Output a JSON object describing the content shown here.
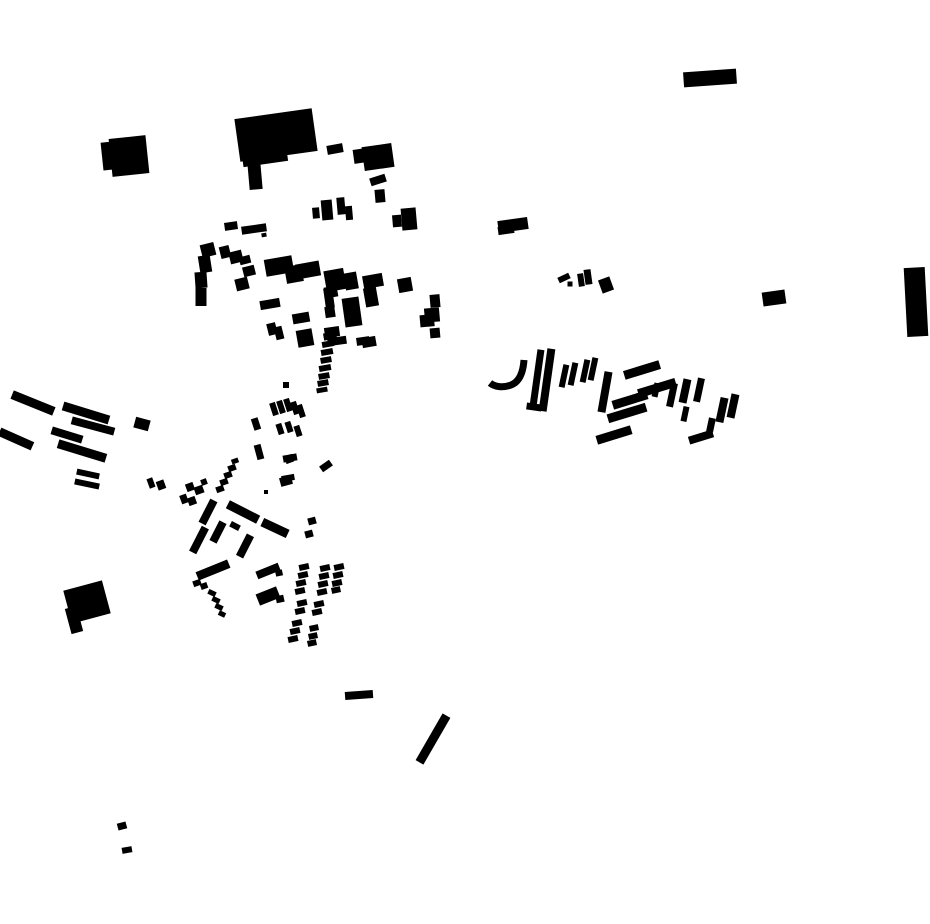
{
  "map": {
    "title": "building-footprint-figure-ground-map",
    "canvas": {
      "width": 930,
      "height": 924,
      "background": "#ffffff",
      "ink": "#000000"
    },
    "buildings": [
      [
        710,
        78,
        53,
        15,
        -4
      ],
      [
        108,
        156,
        12,
        28,
        -6
      ],
      [
        129,
        156,
        37,
        38,
        -6
      ],
      [
        276,
        135,
        78,
        43,
        -8
      ],
      [
        265,
        158,
        45,
        12,
        -8
      ],
      [
        255,
        176,
        13,
        27,
        -5
      ],
      [
        335,
        149,
        16,
        9,
        -10
      ],
      [
        360,
        156,
        13,
        14,
        -8
      ],
      [
        378,
        157,
        30,
        24,
        -8
      ],
      [
        378,
        180,
        16,
        8,
        -18
      ],
      [
        380,
        196,
        10,
        13,
        -5
      ],
      [
        316,
        213,
        7,
        11,
        -5
      ],
      [
        327,
        210,
        11,
        20,
        -5
      ],
      [
        341,
        206,
        8,
        17,
        -5
      ],
      [
        349,
        213,
        7,
        14,
        -5
      ],
      [
        397,
        221,
        9,
        12,
        -5
      ],
      [
        409,
        219,
        15,
        22,
        -5
      ],
      [
        231,
        226,
        13,
        8,
        -8
      ],
      [
        254,
        229,
        25,
        8,
        -8
      ],
      [
        264,
        235,
        5,
        4,
        -10
      ],
      [
        208,
        250,
        14,
        13,
        -14
      ],
      [
        205,
        264,
        12,
        17,
        -9
      ],
      [
        201,
        280,
        12,
        16,
        -4
      ],
      [
        201,
        297,
        11,
        18,
        0
      ],
      [
        225,
        252,
        10,
        12,
        -14
      ],
      [
        236,
        257,
        13,
        12,
        -14
      ],
      [
        245,
        260,
        11,
        8,
        -14
      ],
      [
        249,
        271,
        12,
        10,
        -14
      ],
      [
        242,
        284,
        13,
        12,
        -14
      ],
      [
        279,
        266,
        28,
        17,
        -10
      ],
      [
        294,
        274,
        17,
        17,
        -10
      ],
      [
        308,
        270,
        24,
        15,
        -10
      ],
      [
        329,
        298,
        9,
        20,
        -8
      ],
      [
        270,
        304,
        20,
        9,
        -10
      ],
      [
        335,
        280,
        20,
        21,
        -10
      ],
      [
        331,
        292,
        13,
        11,
        -10
      ],
      [
        351,
        281,
        13,
        17,
        -10
      ],
      [
        373,
        281,
        20,
        13,
        -10
      ],
      [
        371,
        297,
        13,
        19,
        -10
      ],
      [
        405,
        285,
        14,
        14,
        -10
      ],
      [
        352,
        312,
        17,
        29,
        -8
      ],
      [
        330,
        312,
        10,
        11,
        -8
      ],
      [
        332,
        332,
        15,
        10,
        -8
      ],
      [
        337,
        341,
        19,
        8,
        -8
      ],
      [
        363,
        341,
        13,
        8,
        -8
      ],
      [
        369,
        342,
        14,
        10,
        -10
      ],
      [
        435,
        301,
        10,
        13,
        -5
      ],
      [
        432,
        315,
        15,
        14,
        -5
      ],
      [
        431,
        324,
        7,
        5,
        -5
      ],
      [
        435,
        333,
        10,
        10,
        -5
      ],
      [
        424,
        321,
        8,
        12,
        -5
      ],
      [
        301,
        318,
        17,
        10,
        -10
      ],
      [
        272,
        329,
        9,
        12,
        -14
      ],
      [
        279,
        333,
        8,
        13,
        -14
      ],
      [
        305,
        338,
        16,
        17,
        -10
      ],
      [
        330,
        336,
        13,
        7,
        -10
      ],
      [
        328,
        344,
        12,
        6,
        -10
      ],
      [
        327,
        352,
        12,
        6,
        -10
      ],
      [
        326,
        360,
        11,
        6,
        -10
      ],
      [
        325,
        368,
        12,
        6,
        -10
      ],
      [
        324,
        376,
        11,
        6,
        -10
      ],
      [
        323,
        383,
        11,
        6,
        -10
      ],
      [
        322,
        390,
        11,
        5,
        -10
      ],
      [
        286,
        385,
        6,
        6,
        0
      ],
      [
        274,
        409,
        6,
        13,
        -18
      ],
      [
        281,
        407,
        6,
        13,
        -18
      ],
      [
        288,
        405,
        6,
        13,
        -18
      ],
      [
        295,
        408,
        6,
        13,
        -18
      ],
      [
        301,
        411,
        6,
        13,
        -18
      ],
      [
        256,
        424,
        7,
        12,
        -18
      ],
      [
        280,
        429,
        6,
        11,
        -18
      ],
      [
        289,
        427,
        6,
        11,
        -18
      ],
      [
        298,
        431,
        6,
        11,
        -18
      ],
      [
        259,
        452,
        7,
        15,
        -15
      ],
      [
        290,
        458,
        14,
        7,
        -10
      ],
      [
        326,
        466,
        12,
        7,
        -35
      ],
      [
        288,
        478,
        13,
        6,
        -10
      ],
      [
        289,
        459,
        8,
        8,
        -20
      ],
      [
        33,
        403,
        45,
        9,
        22
      ],
      [
        86,
        413,
        48,
        9,
        17
      ],
      [
        16,
        439,
        36,
        9,
        24
      ],
      [
        93,
        426,
        44,
        8,
        15
      ],
      [
        67,
        435,
        32,
        8,
        17
      ],
      [
        82,
        451,
        50,
        9,
        17
      ],
      [
        142,
        424,
        15,
        11,
        15
      ],
      [
        88,
        474,
        23,
        6,
        12
      ],
      [
        87,
        484,
        25,
        6,
        12
      ],
      [
        151,
        483,
        6,
        10,
        -20
      ],
      [
        161,
        485,
        8,
        9,
        -20
      ],
      [
        190,
        487,
        8,
        8,
        -20
      ],
      [
        199,
        490,
        9,
        8,
        -20
      ],
      [
        204,
        482,
        6,
        6,
        -20
      ],
      [
        184,
        499,
        7,
        9,
        -20
      ],
      [
        192,
        501,
        8,
        8,
        -20
      ],
      [
        220,
        489,
        8,
        6,
        -20
      ],
      [
        224,
        482,
        8,
        6,
        -20
      ],
      [
        228,
        475,
        8,
        6,
        -20
      ],
      [
        232,
        468,
        8,
        6,
        -20
      ],
      [
        235,
        461,
        7,
        5,
        -20
      ],
      [
        286,
        481,
        12,
        9,
        -15
      ],
      [
        266,
        492,
        4,
        4,
        0
      ],
      [
        312,
        521,
        8,
        7,
        -15
      ],
      [
        309,
        534,
        8,
        7,
        -15
      ],
      [
        208,
        512,
        8,
        26,
        27
      ],
      [
        243,
        512,
        34,
        9,
        27
      ],
      [
        275,
        528,
        28,
        9,
        25
      ],
      [
        199,
        540,
        8,
        28,
        27
      ],
      [
        218,
        532,
        8,
        22,
        27
      ],
      [
        235,
        526,
        10,
        6,
        27
      ],
      [
        245,
        546,
        8,
        24,
        27
      ],
      [
        213,
        570,
        34,
        9,
        -22
      ],
      [
        268,
        571,
        24,
        8,
        -22
      ],
      [
        197,
        583,
        8,
        6,
        -20
      ],
      [
        204,
        586,
        7,
        6,
        -20
      ],
      [
        268,
        596,
        22,
        12,
        -22
      ],
      [
        212,
        593,
        8,
        5,
        25
      ],
      [
        216,
        600,
        8,
        5,
        25
      ],
      [
        219,
        607,
        8,
        5,
        25
      ],
      [
        222,
        614,
        7,
        5,
        25
      ],
      [
        304,
        567,
        10,
        6,
        -12
      ],
      [
        303,
        575,
        10,
        6,
        -12
      ],
      [
        301,
        583,
        10,
        6,
        -12
      ],
      [
        300,
        591,
        10,
        6,
        -12
      ],
      [
        302,
        603,
        10,
        6,
        -12
      ],
      [
        300,
        611,
        10,
        6,
        -12
      ],
      [
        297,
        623,
        10,
        6,
        -12
      ],
      [
        295,
        631,
        10,
        6,
        -12
      ],
      [
        293,
        639,
        10,
        6,
        -12
      ],
      [
        325,
        568,
        10,
        6,
        -12
      ],
      [
        324,
        576,
        10,
        6,
        -12
      ],
      [
        323,
        584,
        10,
        6,
        -12
      ],
      [
        322,
        592,
        10,
        6,
        -12
      ],
      [
        319,
        604,
        10,
        6,
        -12
      ],
      [
        317,
        612,
        10,
        6,
        -12
      ],
      [
        314,
        628,
        9,
        6,
        -12
      ],
      [
        313,
        636,
        9,
        6,
        -12
      ],
      [
        312,
        643,
        9,
        6,
        -12
      ],
      [
        339,
        567,
        10,
        6,
        -12
      ],
      [
        338,
        575,
        10,
        6,
        -12
      ],
      [
        337,
        583,
        10,
        6,
        -12
      ],
      [
        336,
        590,
        9,
        6,
        -12
      ],
      [
        279,
        573,
        7,
        6,
        -12
      ],
      [
        280,
        599,
        8,
        7,
        -12
      ],
      [
        87,
        602,
        40,
        34,
        -15
      ],
      [
        74,
        620,
        12,
        26,
        -15
      ],
      [
        513,
        225,
        30,
        12,
        -8
      ],
      [
        506,
        230,
        16,
        8,
        -8
      ],
      [
        564,
        278,
        12,
        6,
        -25
      ],
      [
        570,
        284,
        5,
        5,
        0
      ],
      [
        581,
        280,
        6,
        13,
        -8
      ],
      [
        588,
        277,
        7,
        15,
        -8
      ],
      [
        606,
        285,
        12,
        14,
        -20
      ],
      [
        537,
        378,
        7,
        57,
        8
      ],
      [
        547,
        380,
        8,
        63,
        8
      ],
      [
        534,
        407,
        15,
        7,
        8
      ],
      [
        564,
        376,
        6,
        23,
        12
      ],
      [
        573,
        374,
        6,
        23,
        12
      ],
      [
        585,
        371,
        6,
        23,
        12
      ],
      [
        593,
        369,
        6,
        23,
        12
      ],
      [
        605,
        392,
        8,
        41,
        10
      ],
      [
        642,
        370,
        37,
        9,
        -17
      ],
      [
        657,
        388,
        39,
        9,
        -17
      ],
      [
        630,
        400,
        36,
        9,
        -17
      ],
      [
        627,
        413,
        40,
        9,
        -17
      ],
      [
        656,
        390,
        6,
        14,
        12
      ],
      [
        614,
        435,
        36,
        9,
        -17
      ],
      [
        672,
        395,
        7,
        24,
        12
      ],
      [
        685,
        391,
        8,
        24,
        12
      ],
      [
        685,
        414,
        6,
        15,
        12
      ],
      [
        699,
        390,
        7,
        24,
        12
      ],
      [
        701,
        437,
        25,
        8,
        -17
      ],
      [
        722,
        410,
        8,
        25,
        12
      ],
      [
        733,
        406,
        8,
        24,
        12
      ],
      [
        711,
        425,
        7,
        14,
        12
      ],
      [
        916,
        302,
        21,
        69,
        -3
      ],
      [
        774,
        298,
        23,
        14,
        -8
      ],
      [
        359,
        695,
        28,
        8,
        -4
      ],
      [
        433,
        739,
        9,
        54,
        30
      ],
      [
        122,
        826,
        9,
        7,
        -15
      ],
      [
        127,
        850,
        10,
        6,
        -10
      ]
    ],
    "curves": [
      {
        "d": "M 524 360 C 523 374 519 382 511 385 C 503 388 495 387 490 383",
        "width": 7
      }
    ]
  }
}
